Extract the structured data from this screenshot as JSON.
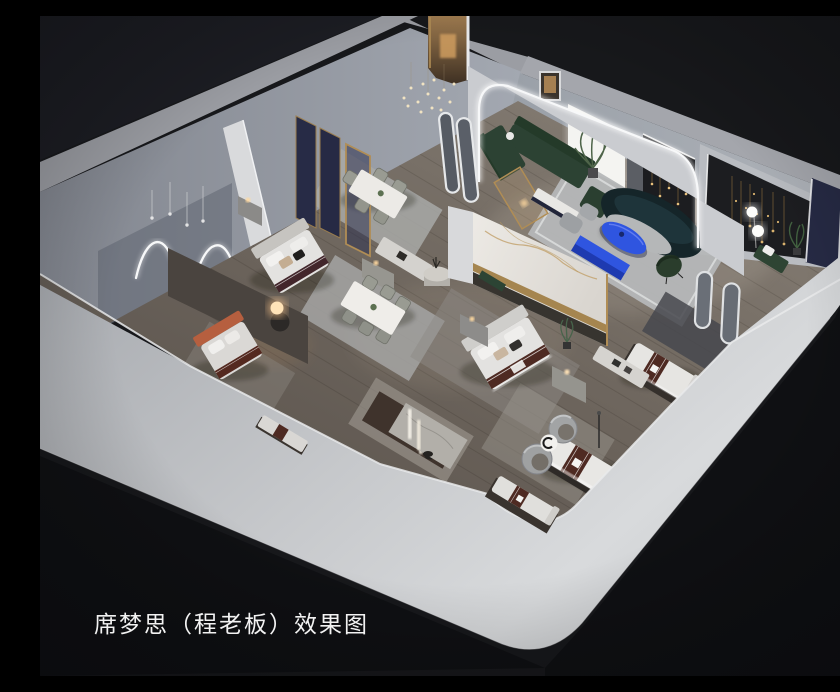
{
  "image": {
    "kind": "3d-interior-rendering",
    "subject": "Bird's-eye cutaway rendering of a Simmons mattress showroom floor plan"
  },
  "caption": {
    "text": "席梦思（程老板）效果图"
  },
  "colors": {
    "bg": "#17181b",
    "bg-deep": "#0f1013",
    "bg-soft": "#22242a",
    "wall-front": "#c6c8cb",
    "wall-front-light": "#d8dadc",
    "wall-front-dark": "#a7aaaf",
    "wall-band": "#9b9da3",
    "wall-face": "#82868f",
    "wall-face-light": "#a8adb5",
    "floor-dark": "#564f49",
    "floor-light": "#8d857c",
    "rug-light": "#b5b7b8",
    "rug-dark": "#3f332c",
    "marble": "#edeae5",
    "gold": "#b08d55",
    "navy": "#262a44",
    "niche": "#1c1d20",
    "teal": "#152529",
    "sofa-green": "#2c4233",
    "blue": "#2f55e0",
    "blue-dark": "#1e3ab0",
    "terracotta": "#b65f3f",
    "runner": "#4e2a22",
    "bedding": "#e3e2e0",
    "led": "#f7f8f9",
    "warm": "#ffc98f",
    "text": "#f2f2f2"
  },
  "scene": {
    "rooms": [
      "neon-art-room",
      "navy-panel-bed-vignette",
      "terracotta-bed-room",
      "dining-display",
      "marble-partition-bedroom",
      "arched-lounge",
      "dark-gallery-wall",
      "mirror-corner",
      "mattress-display-floor"
    ]
  }
}
